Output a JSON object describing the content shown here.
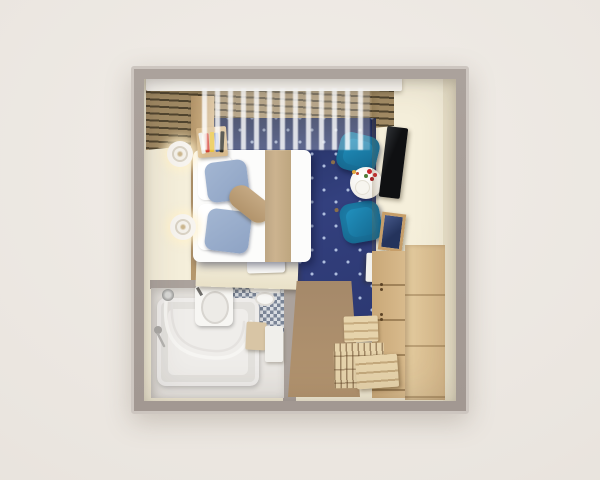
{
  "meta": {
    "description": "Top-down 3D cutaway rendering of a compact hotel room: double bed with blue pillows on a navy patterned carpet, sheer curtained window wall, two teal armchairs with a round flower table, TV console with mirror and mini fridge, wooden wardrobe and slatted luggage bench by the tan entry mat, and an en-suite bathroom with curved glass shower over the tub, mosaic tiled wall, sink and toilet.",
    "visible_text": "none"
  },
  "palette": {
    "bg": "#f1ede8",
    "wall": "#aba29c",
    "wallEdge": "#cdc6c0",
    "cream": "#f5efdb",
    "creamDark": "#e9e1c9",
    "creamLedge": "#e9e1c8",
    "slatBoard": "#a18a64",
    "slatGap": "#51452f",
    "pelmet": "#fbf9f4",
    "carpet": "#33407e",
    "carpetDeep": "#212d5c",
    "carpetDot": "#aebdde",
    "bedWhite": "#fcfcfb",
    "runner": "#ccb38f",
    "pillowBlue": "#a3b6d2",
    "pillowBeige": "#c5a983",
    "wood": "#d8ba8c",
    "woodLight": "#e3cb9f",
    "woodSlat": "#e6d3ab",
    "chair": "#1e82ad",
    "chairDark": "#135f85",
    "chairLeg": "#8a6f4a",
    "table": "#f0ede7",
    "flower": "#c8262b",
    "leaf": "#4e7d3a",
    "plate": "#e0a83c",
    "tv": "#0f1012",
    "tvEdge": "#2e3135",
    "mirrorFrame": "#c69e69",
    "mirrorGlass": "#24335c",
    "fridge": "#f2f1ed",
    "mat": "#b3946f",
    "bathFloor": "#e9e6e2",
    "tubEdge": "#eeecea",
    "tubFill": "#e3e1dd",
    "tubWell": "#efedea",
    "porcelain": "#f7f6f3",
    "mosaicA": "#67748a",
    "mosaicB": "#d8dde3",
    "stool": "#d8c5a5",
    "cabinet": "#f0efeb",
    "lamp": "#f7f4ef",
    "lampRing": "#d9d2c4",
    "metal": "#9a9a98",
    "towel": "#fbfaf7",
    "bookRed": "#d23b2f",
    "bookYellow": "#e8c23a",
    "bookBlue": "#2a4fa0",
    "bookBlack": "#25251f",
    "bookWhite": "#efefec"
  },
  "objects": [
    {
      "name": "window-curtains"
    },
    {
      "name": "wall-lamp",
      "count": 2
    },
    {
      "name": "book-stack"
    },
    {
      "name": "double-bed"
    },
    {
      "name": "bed-runner"
    },
    {
      "name": "blue-pillows",
      "count": 2
    },
    {
      "name": "bolster-pillow"
    },
    {
      "name": "navy-patterned-carpet"
    },
    {
      "name": "teal-armchair",
      "count": 2
    },
    {
      "name": "round-coffee-table-with-flowers"
    },
    {
      "name": "wall-tv"
    },
    {
      "name": "framed-mirror"
    },
    {
      "name": "mini-fridge"
    },
    {
      "name": "wooden-wardrobe"
    },
    {
      "name": "slatted-luggage-bench"
    },
    {
      "name": "entry-mat"
    },
    {
      "name": "bathtub-with-glass-screen"
    },
    {
      "name": "hand-shower"
    },
    {
      "name": "sink"
    },
    {
      "name": "toilet"
    },
    {
      "name": "mosaic-tile-wall"
    },
    {
      "name": "stool"
    },
    {
      "name": "bath-cabinet"
    },
    {
      "name": "towel"
    }
  ]
}
